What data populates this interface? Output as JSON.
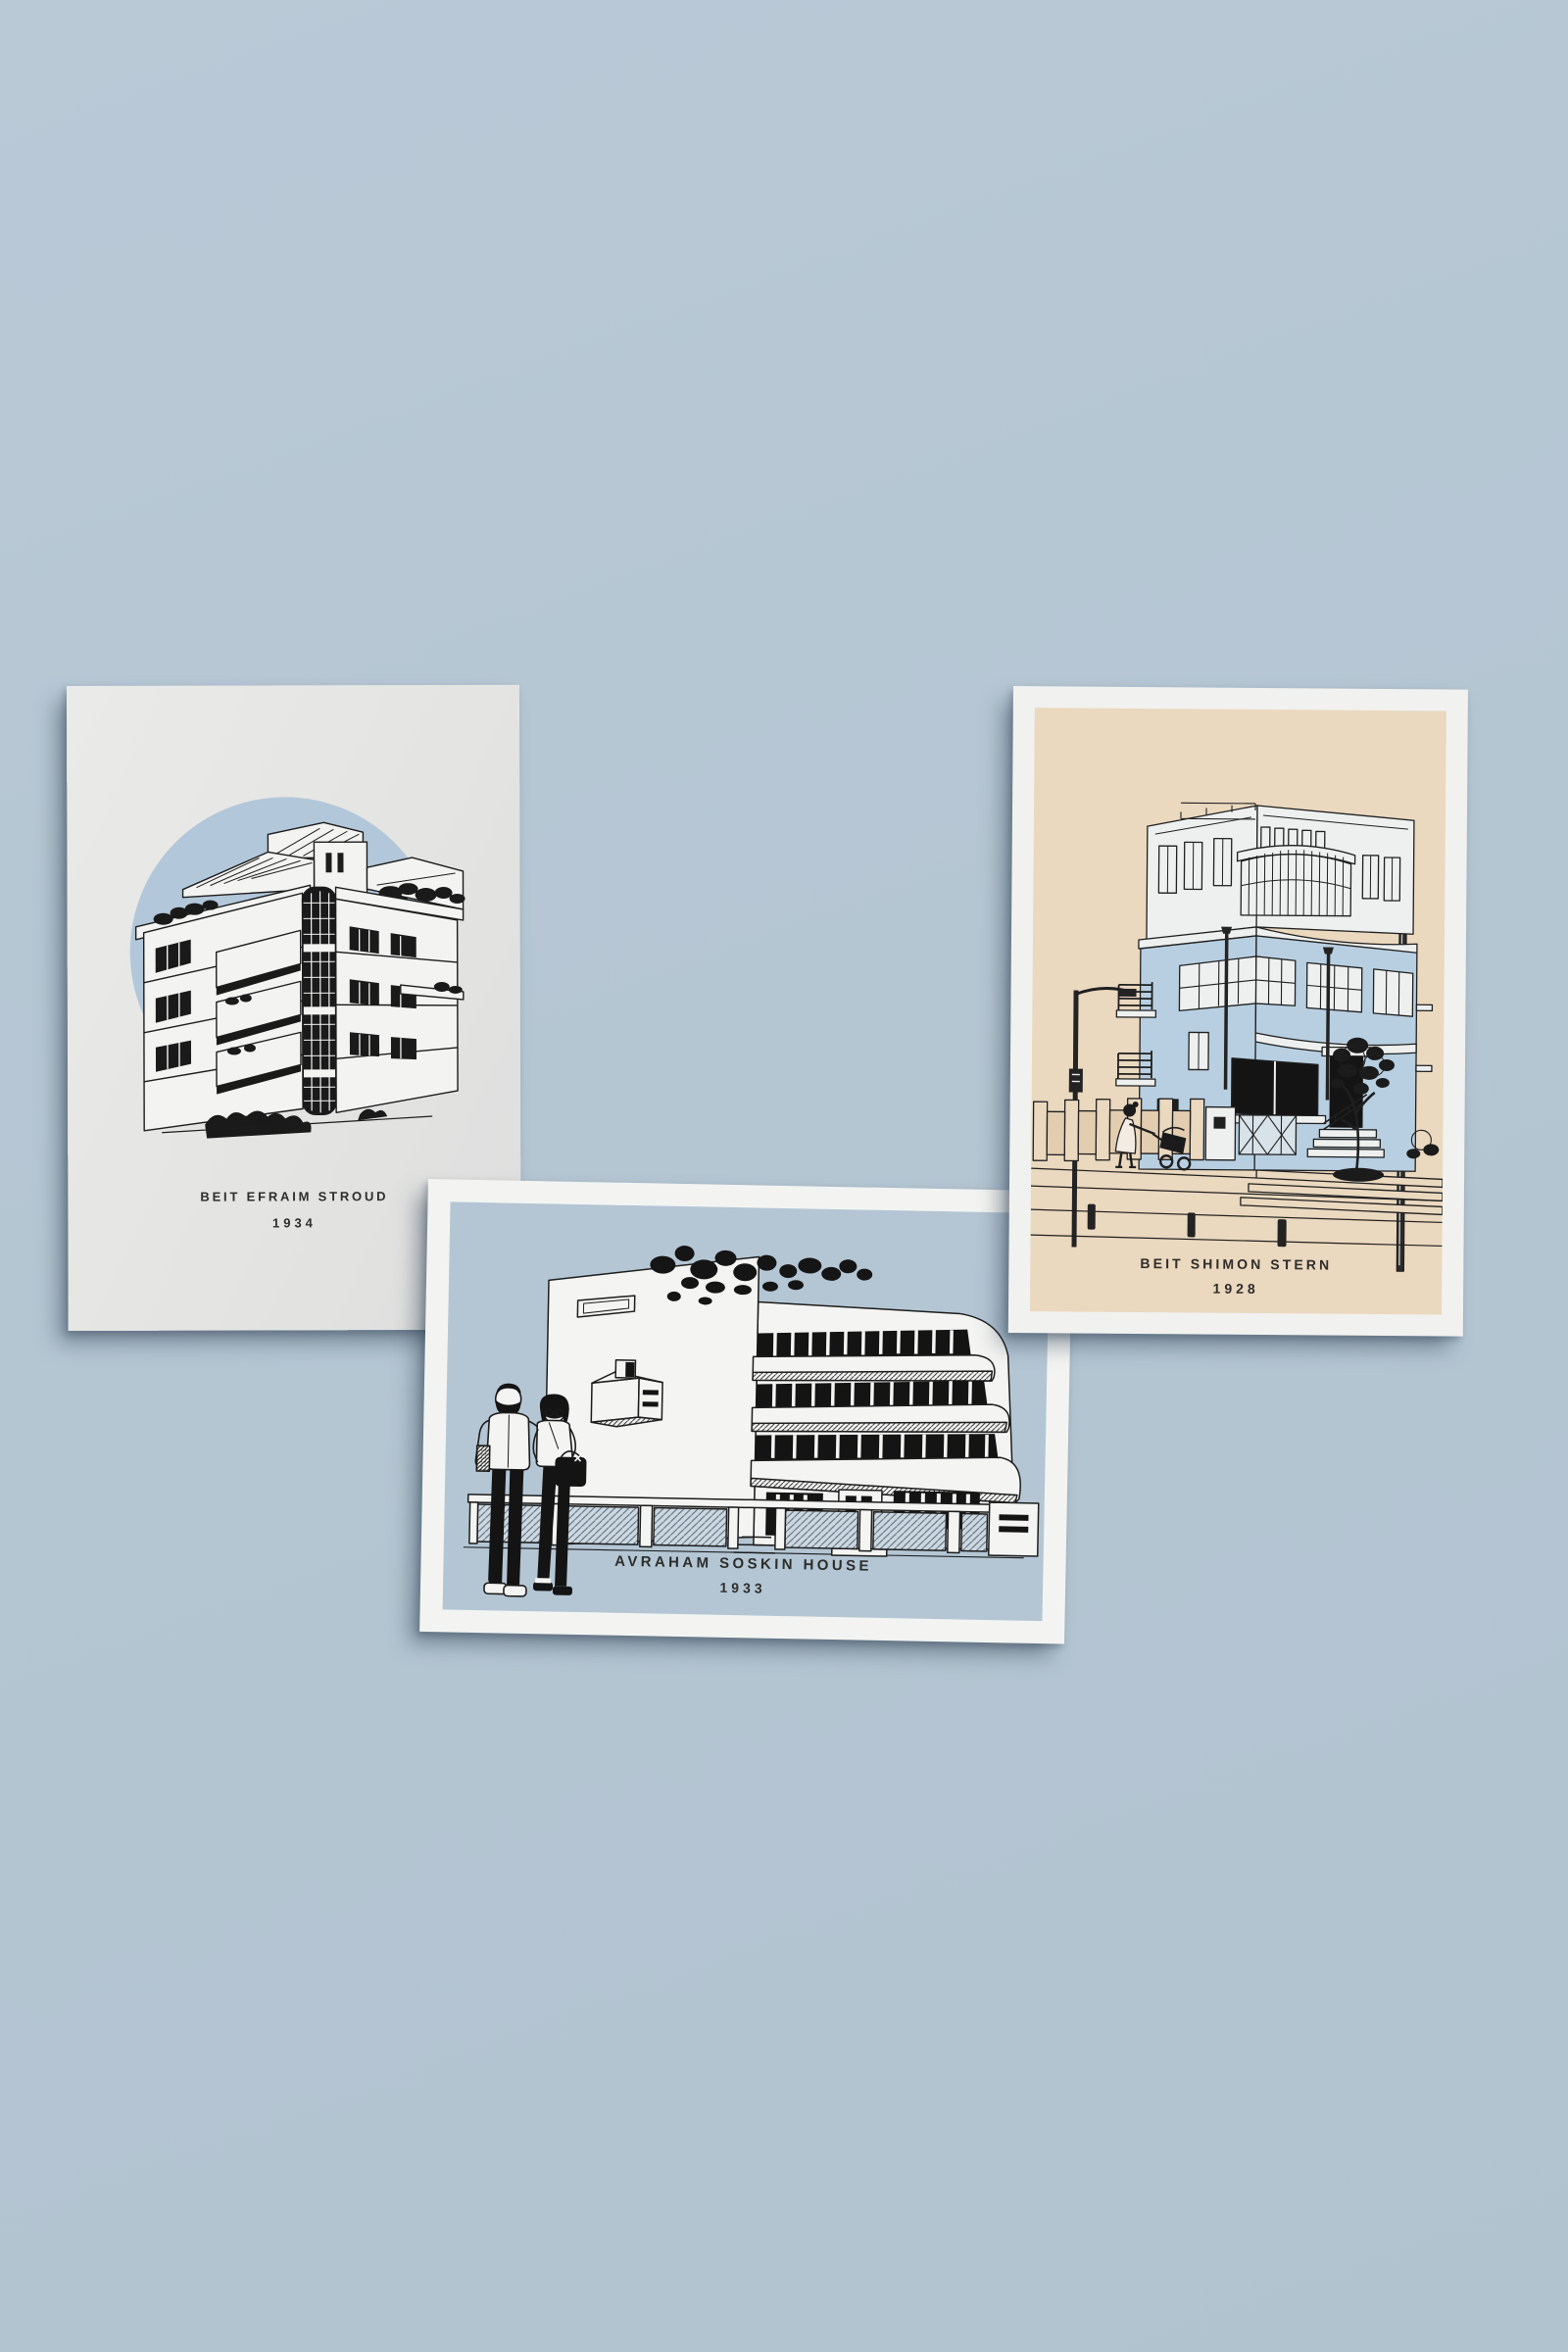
{
  "scene": {
    "description": "Three Bauhaus architecture art prints lying on a light blue surface",
    "background_color": "#b5c6d3",
    "ink_color": "#1c1c1c"
  },
  "prints": [
    {
      "title": "BEIT EFRAIM STROUD",
      "year": "1934",
      "paper_color": "#e5e5e3",
      "circle_color": "#b2c7d9",
      "subject": "black and white Bauhaus apartment building in blue circle"
    },
    {
      "title": "AVRAHAM SOSKIN HOUSE",
      "year": "1933",
      "border_color": "#f3f4f2",
      "panel_color": "#b4c6d4",
      "subject": "white modernist house with curved balconies and a couple standing in front"
    },
    {
      "title": "BEIT SHIMON STERN",
      "year": "1928",
      "border_color": "#f1f1ef",
      "panel_color": "#ead8bf",
      "subject": "light blue corner building with curved glazed bay, tree, lampposts and woman with stroller"
    }
  ]
}
